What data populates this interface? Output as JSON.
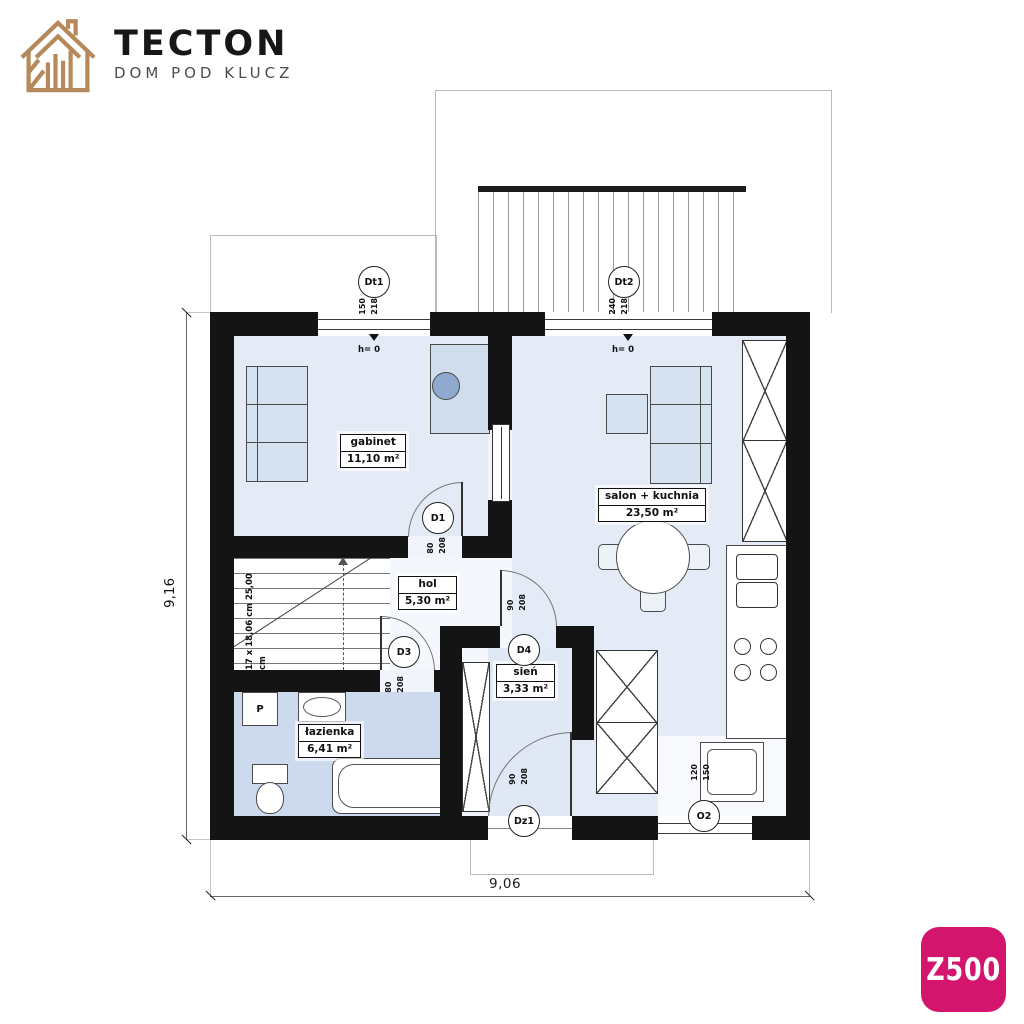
{
  "logo": {
    "brand": "TECTON",
    "tagline": "DOM POD KLUCZ",
    "color": "#b5895a"
  },
  "badge": {
    "label": "Z500",
    "color": "#d4156e"
  },
  "plan": {
    "rooms": [
      {
        "name": "gabinet",
        "area": "11,10 m²"
      },
      {
        "name": "salon + kuchnia",
        "area": "23,50 m²"
      },
      {
        "name": "hol",
        "area": "5,30 m²"
      },
      {
        "name": "sień",
        "area": "3,33 m²"
      },
      {
        "name": "łazienka",
        "area": "6,41 m²"
      }
    ],
    "openings": [
      {
        "code": "Dt1",
        "w": "150",
        "h": "218"
      },
      {
        "code": "Dt2",
        "w": "240",
        "h": "218"
      },
      {
        "code": "D1",
        "w": "80",
        "h": "208"
      },
      {
        "code": "D3",
        "w": "80",
        "h": "208"
      },
      {
        "code": "D4",
        "w": "90",
        "h": "208"
      },
      {
        "code": "Dz1",
        "w": "90",
        "h": "208"
      },
      {
        "code": "O2",
        "w": "120",
        "h": "150"
      }
    ],
    "sill_label": "h= 0",
    "stairs": {
      "line1": "17 x 18,06 cm",
      "line2": "25,00 cm"
    },
    "dims": {
      "height": "9,16",
      "width": "9,06"
    },
    "washer": "P",
    "wall_color": "#141414",
    "room_fill": "#e4ebf6",
    "bath_fill": "#cdd9ec"
  }
}
